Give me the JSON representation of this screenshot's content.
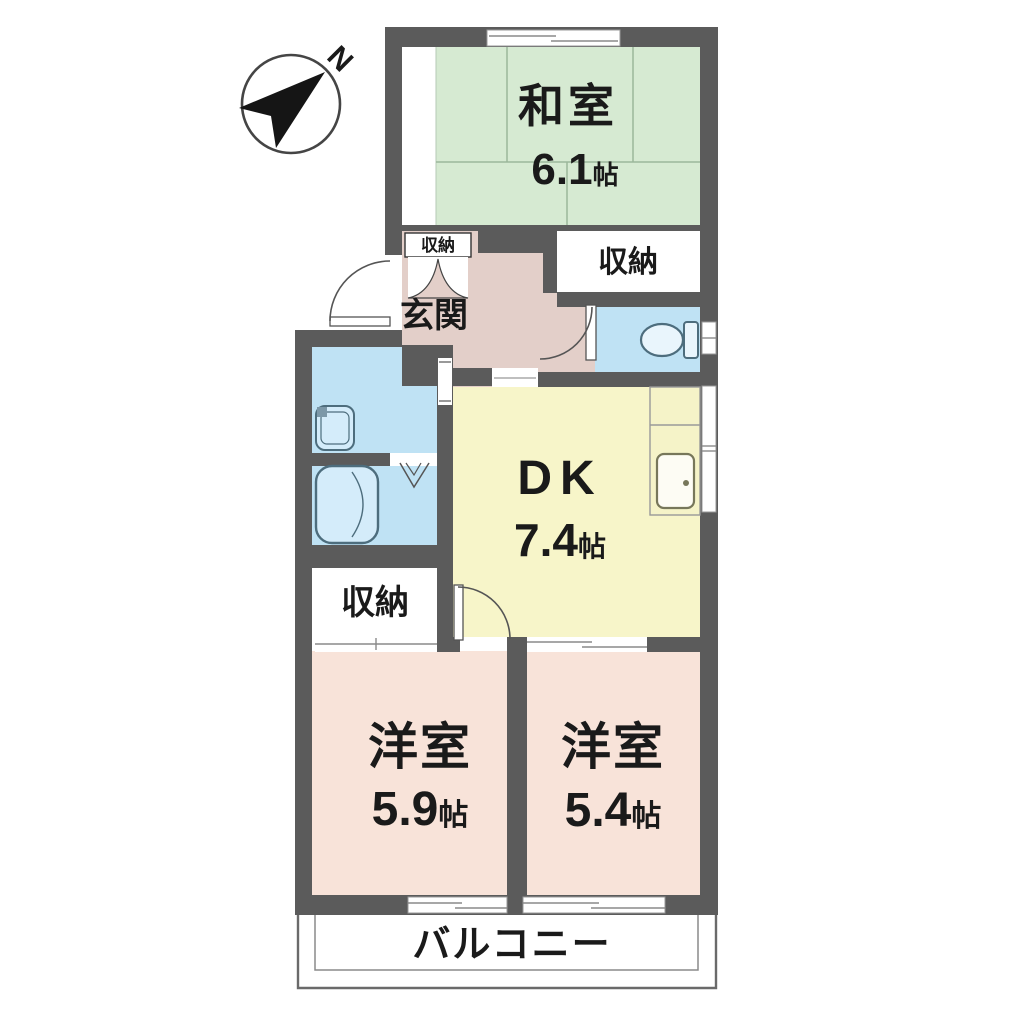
{
  "compass": {
    "north_label": "N"
  },
  "rooms": {
    "washitsu": {
      "label": "和室",
      "size_value": "6.1",
      "size_unit": "帖"
    },
    "dk": {
      "label": "DK",
      "size_value": "7.4",
      "size_unit": "帖"
    },
    "western_a": {
      "label": "洋室",
      "size_value": "5.9",
      "size_unit": "帖"
    },
    "western_b": {
      "label": "洋室",
      "size_value": "5.4",
      "size_unit": "帖"
    },
    "entrance": {
      "label": "玄関"
    },
    "entrance_closet": {
      "label": "収納"
    },
    "closet_east": {
      "label": "収納"
    },
    "closet_west": {
      "label": "収納"
    },
    "balcony": {
      "label": "バルコニー"
    }
  },
  "fixtures": {
    "toilet": "toilet",
    "bathtub": "bathtub",
    "wash_basin": "wash-basin",
    "kitchen_sink": "kitchen-sink",
    "kitchen_counter": "kitchen-counter"
  },
  "colors": {
    "wall": "#5b5b5b",
    "tatami_room": "#d6ead2",
    "dining_kitchen": "#f7f5c9",
    "western_room": "#f8e3d9",
    "hall": "#e3cfc9",
    "wet_area": "#bfe2f4",
    "closet": "#ffffff",
    "text": "#1a1a1a"
  }
}
